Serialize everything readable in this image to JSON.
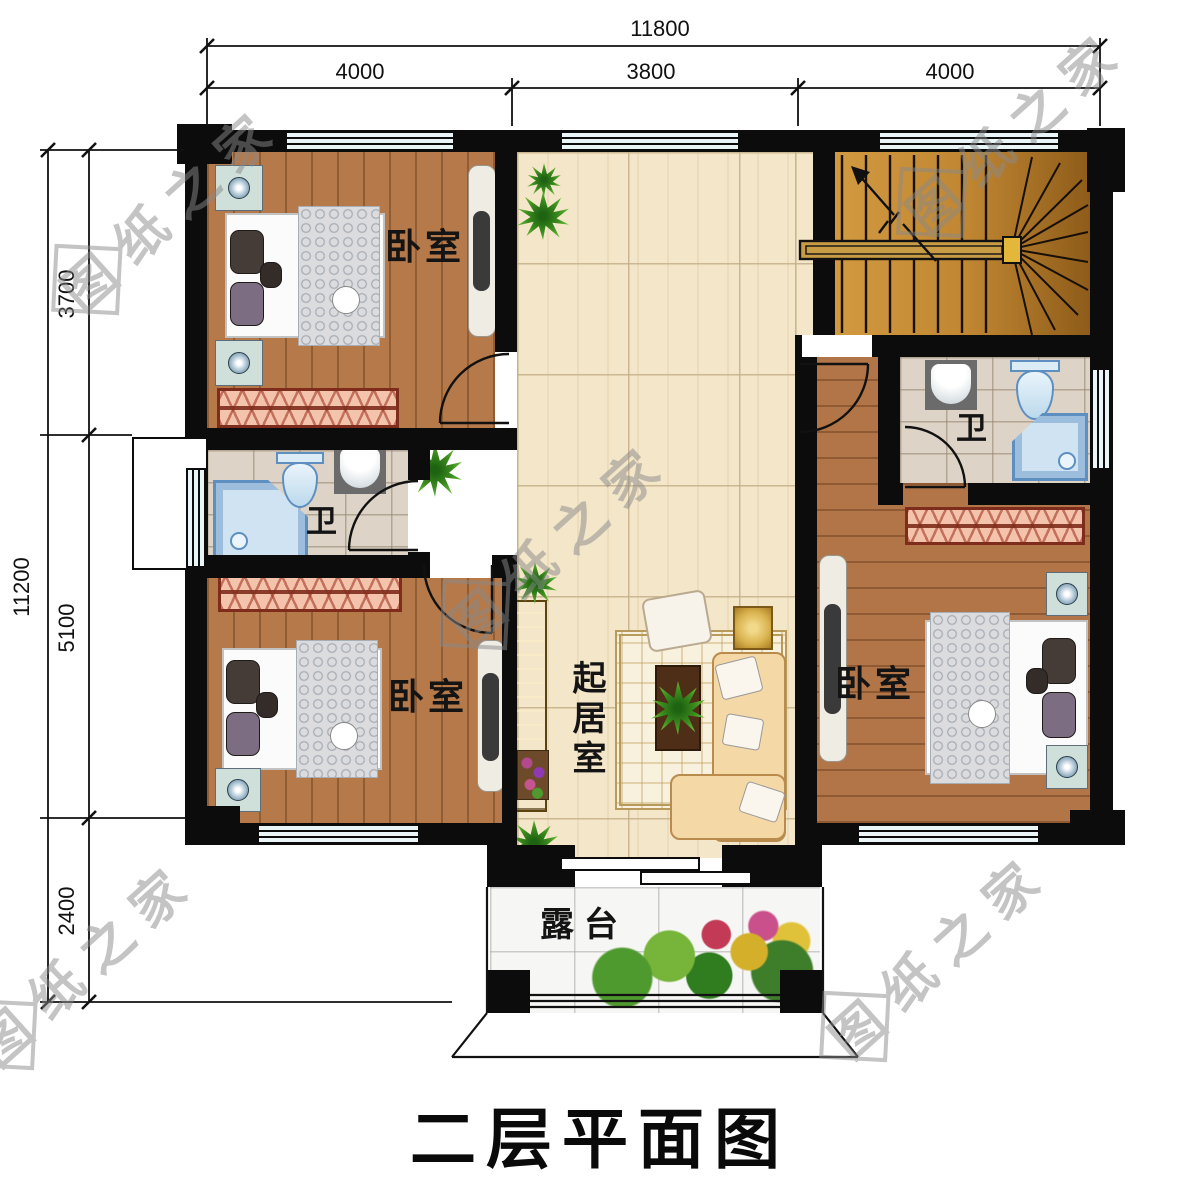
{
  "title": "二层平面图",
  "watermark": {
    "first": "图",
    "rest": "纸之家"
  },
  "dimensions": {
    "top": {
      "total": "11800",
      "segments": [
        "4000",
        "3800",
        "4000"
      ]
    },
    "left": {
      "total": "11200",
      "segments": [
        "3700",
        "5100",
        "2400"
      ]
    }
  },
  "rooms": {
    "bedroom_top_left": "卧室",
    "bedroom_bottom_left": "卧室",
    "bedroom_right": "卧室",
    "bathroom_left": "卫",
    "bathroom_right": "卫",
    "living_room": "起居室",
    "terrace": "露台"
  }
}
